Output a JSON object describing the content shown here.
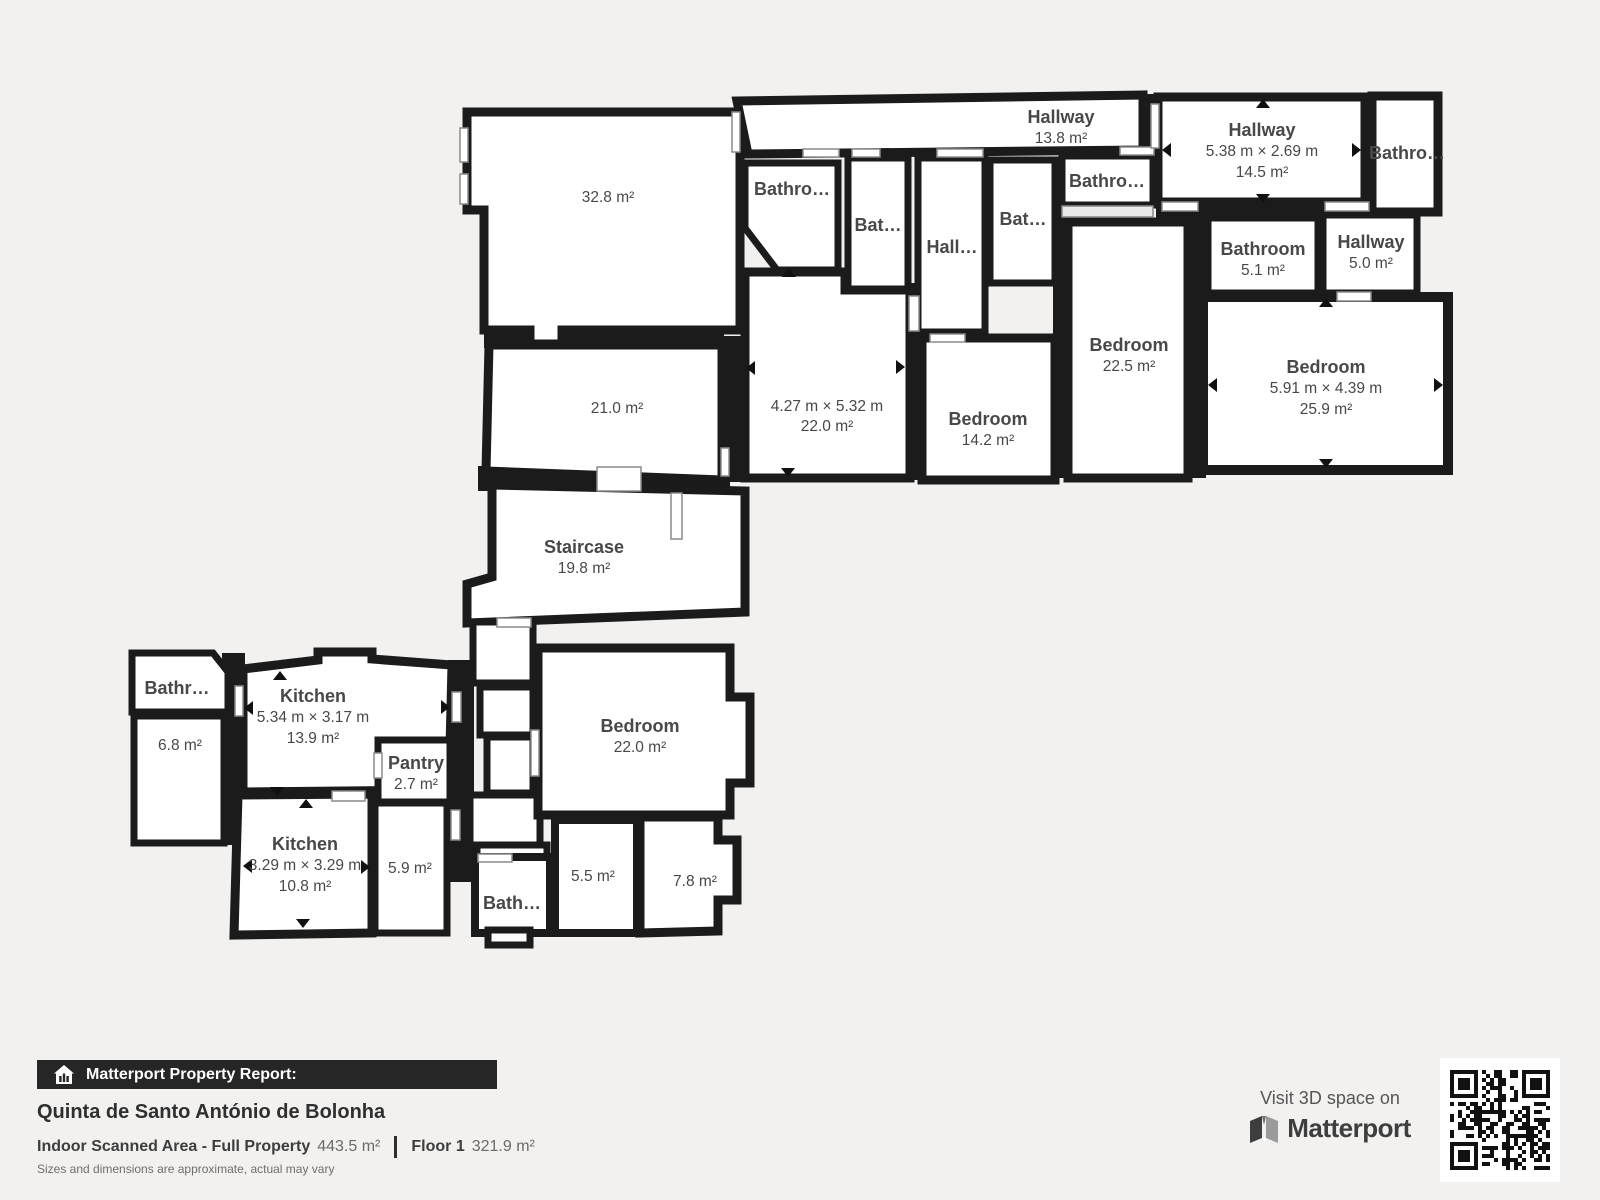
{
  "plan": {
    "rooms": [
      {
        "name": "Hallway",
        "area": "13.8 m²"
      },
      {
        "name": "Hallway",
        "dims": "5.38 m × 2.69 m",
        "area": "14.5 m²"
      },
      {
        "name": "Bathro…"
      },
      {
        "name": "Bathro…"
      },
      {
        "name": "Bat…"
      },
      {
        "name": "Hall…"
      },
      {
        "name": "Bat…"
      },
      {
        "name": "Bathro…"
      },
      {
        "dims": "4.27 m × 5.32 m",
        "area": "22.0 m²"
      },
      {
        "name": "Bedroom",
        "area": "14.2 m²"
      },
      {
        "name": "Bedroom",
        "area": "22.5 m²"
      },
      {
        "name": "Bathroom",
        "area": "5.1 m²"
      },
      {
        "name": "Hallway",
        "area": "5.0 m²"
      },
      {
        "name": "Bedroom",
        "dims": "5.91 m × 4.39 m",
        "area": "25.9 m²"
      },
      {
        "area": "32.8 m²"
      },
      {
        "area": "21.0 m²"
      },
      {
        "name": "Staircase",
        "area": "19.8 m²"
      },
      {
        "name": "Bathr…"
      },
      {
        "area": "6.8 m²"
      },
      {
        "name": "Kitchen",
        "dims": "5.34 m × 3.17 m",
        "area": "13.9 m²"
      },
      {
        "name": "Pantry",
        "area": "2.7 m²"
      },
      {
        "name": "Kitchen",
        "dims": "3.29 m × 3.29 m",
        "area": "10.8 m²"
      },
      {
        "area": "5.9 m²"
      },
      {
        "name": "Bedroom",
        "area": "22.0 m²"
      },
      {
        "name": "Bath…"
      },
      {
        "area": "5.5 m²"
      },
      {
        "area": "7.8 m²"
      }
    ]
  },
  "footer": {
    "report_label": "Matterport Property Report:",
    "property_name": "Quinta de Santo António de Bolonha",
    "scanned_area_label": "Indoor Scanned Area - Full Property",
    "scanned_area_value": "443.5 m²",
    "floor_label": "Floor 1",
    "floor_value": "321.9 m²",
    "disclaimer": "Sizes and dimensions are approximate, actual may vary"
  },
  "cta": {
    "visit_label": "Visit 3D space on",
    "brand": "Matterport"
  },
  "colors": {
    "background": "#f2f1ef",
    "walls": "#1b1b1b",
    "room_fill": "#ffffff",
    "label_text": "#484848",
    "banner_bg": "#262626"
  }
}
